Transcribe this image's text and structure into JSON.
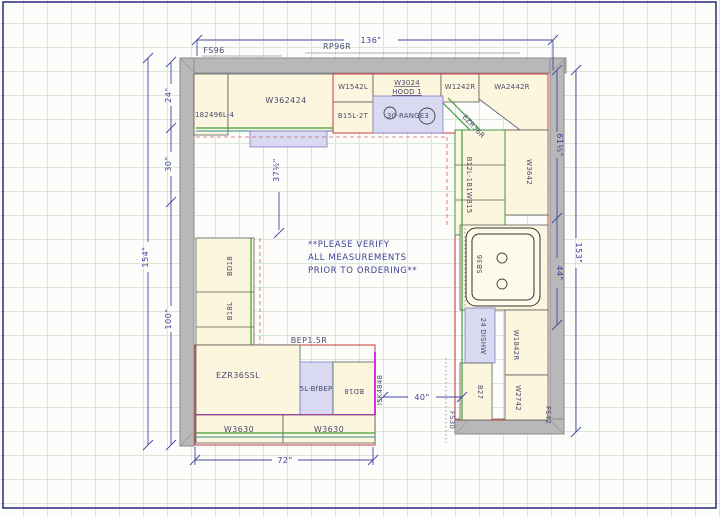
{
  "note": {
    "line1": "**PLEASE VERIFY",
    "line2": "ALL MEASUREMENTS",
    "line3": "PRIOR TO ORDERING**"
  },
  "dims": {
    "top": "136\"",
    "left_outer": "154\"",
    "left_24": "24\"",
    "left_30": "30\"",
    "left_100": "100\"",
    "left_37": "37½\"",
    "right_61": "61½\"",
    "right_44": "44\"",
    "right_153": "153\"",
    "bottom_72": "72\"",
    "aisle_40": "40\""
  },
  "labels": {
    "fs96": "FS96",
    "rp96r": "RP96R",
    "tall_fridge": "182496L-4",
    "w362424": "W362424",
    "w1542l": "W1542L",
    "w3024": "W3024",
    "hood": "HOOD 1",
    "b15l_2t": "B15L-2T",
    "range": "30-RANGE3",
    "w1242r": "W1242R",
    "wa2442r": "WA2442R",
    "ezr36r": "EZR36R",
    "w3642": "W3642",
    "b12l_group": "B12L-1B1WB15",
    "sink": "SB36",
    "dishwasher": "24 DISHW",
    "w1842r": "W1842R",
    "b27": "B27",
    "w2742": "W2742",
    "fs42": "FS42",
    "fs30": "FS30",
    "bd18_left": "BD18",
    "b18l": "B18L",
    "bep15r": "BEP1.5R",
    "ezr36ssl": "EZR36SSL",
    "bfbep": "5L-BfBEP",
    "bd18_island": "BD18",
    "isk4848": "ISK4848",
    "w3630_a": "W3630",
    "w3630_b": "W3630"
  },
  "colors": {
    "wall": "#b8b8b8",
    "cabinet_fill": "#fcf6de",
    "appliance_fill": "#d9d9f2",
    "dimension": "#3f3f96",
    "red_outline": "#cc3b3b",
    "counter_green": "#3f9b3f",
    "counter_teal": "#2a9090",
    "island_magenta": "#e02ae0",
    "grid": "#d8e7d8"
  }
}
